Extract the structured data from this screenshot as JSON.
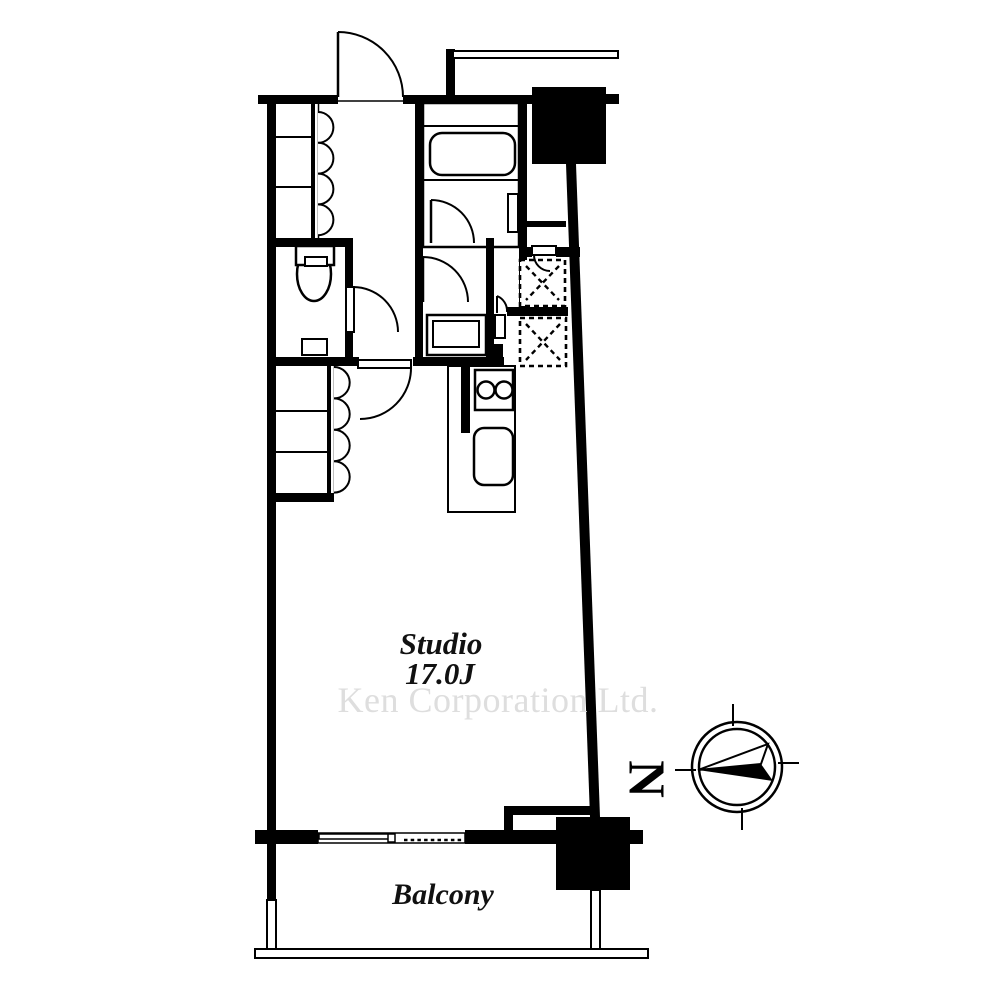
{
  "labels": {
    "room": "Studio",
    "room_size": "17.0J",
    "balcony": "Balcony",
    "north": "N",
    "watermark": "Ken Corporation Ltd."
  },
  "colors": {
    "wall": "#000000",
    "background": "#ffffff",
    "watermark": "#dedede"
  },
  "compass": {
    "north_label": "N",
    "needle_points": "left"
  },
  "fixtures": [
    "entrance-door",
    "upper-closet-folding-doors",
    "toilet",
    "toilet-door",
    "bathroom",
    "bathtub",
    "bathroom-door",
    "washbasin",
    "washroom-door",
    "washing-machine-space",
    "refrigerator-space",
    "kitchen-counter",
    "two-burner-stove",
    "kitchen-sink",
    "lower-closet-folding-doors",
    "hall-studio-door",
    "top-pillar",
    "bottom-pillar",
    "sliding-window",
    "balcony-railing"
  ]
}
